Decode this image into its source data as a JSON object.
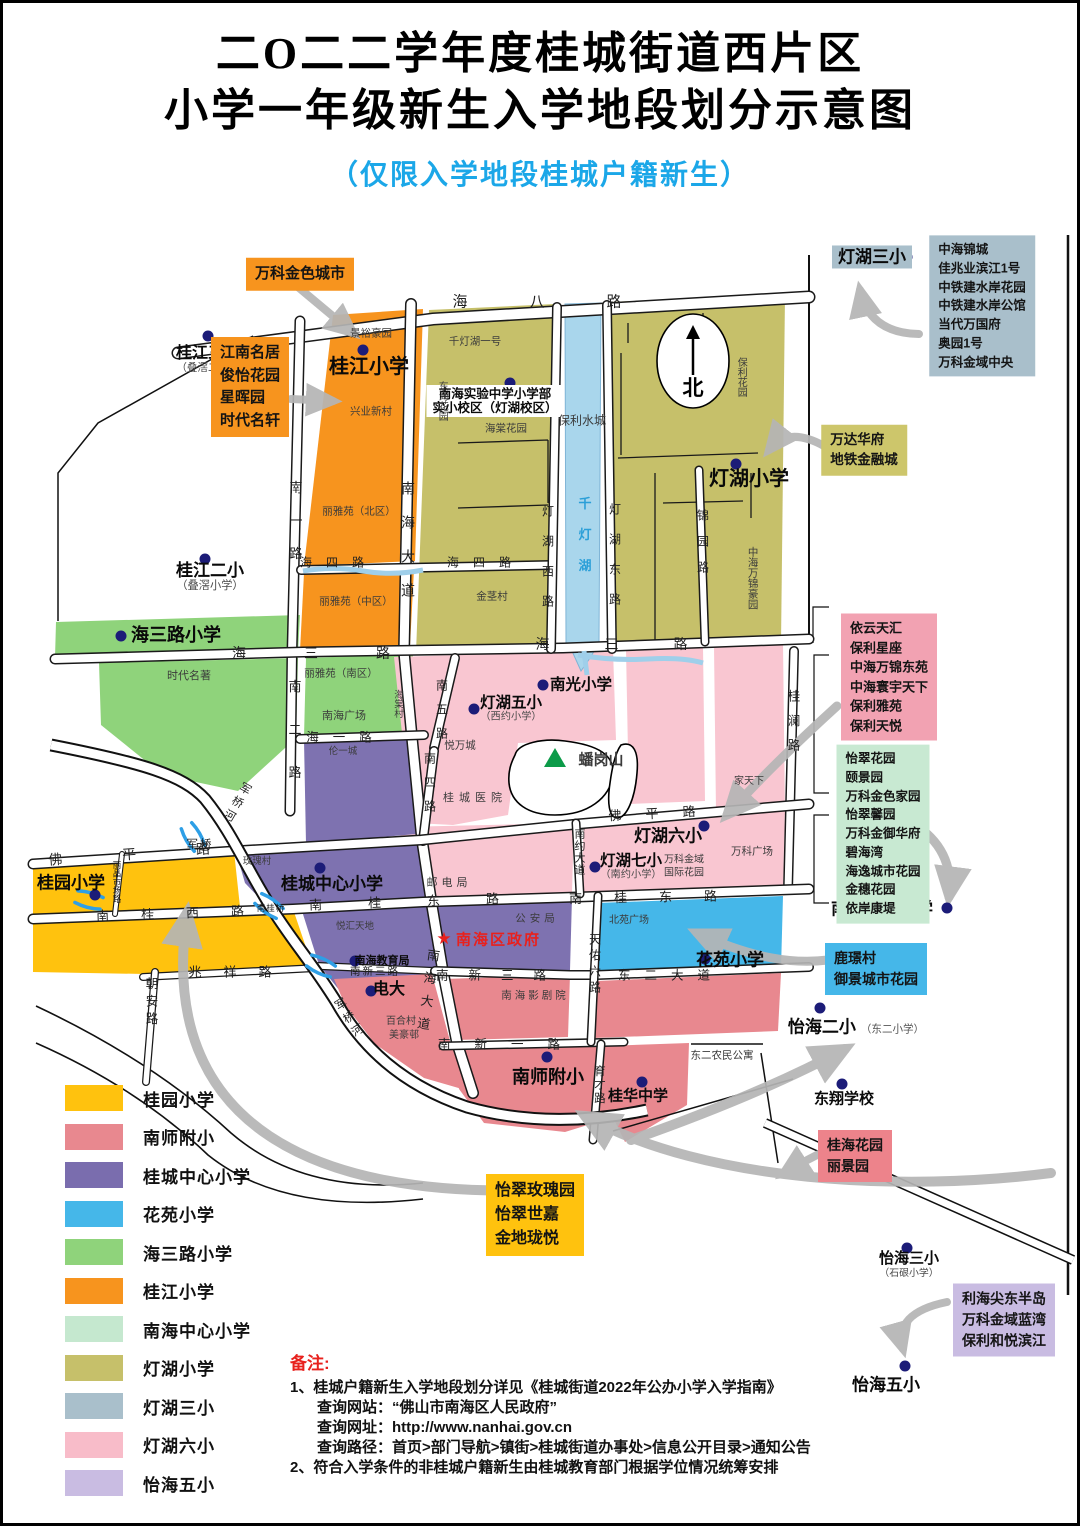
{
  "title": {
    "line1": "二O二二学年度桂城街道西片区",
    "line2": "小学一年级新生入学地段划分示意图",
    "subtitle": "（仅限入学地段桂城户籍新生）"
  },
  "legend": {
    "items": [
      {
        "label": "桂园小学",
        "color": "#FFC20E"
      },
      {
        "label": "南师附小",
        "color": "#E8888F"
      },
      {
        "label": "桂城中心小学",
        "color": "#7A6DAE"
      },
      {
        "label": "花苑小学",
        "color": "#45B7E9"
      },
      {
        "label": "海三路小学",
        "color": "#8FD37B"
      },
      {
        "label": "桂江小学",
        "color": "#F7941E"
      },
      {
        "label": "南海中心小学",
        "color": "#C5E8CF"
      },
      {
        "label": "灯湖小学",
        "color": "#C6C06A"
      },
      {
        "label": "灯湖三小",
        "color": "#A9BFCB"
      },
      {
        "label": "灯湖六小",
        "color": "#F8BCC9"
      },
      {
        "label": "怡海五小",
        "color": "#C9BCE2"
      }
    ]
  },
  "notes": {
    "heading": "备注:",
    "lines": [
      {
        "text": "1、桂城户籍新生入学地段划分详见《桂城街道2022年公办小学入学指南》",
        "indent": false
      },
      {
        "text": "查询网站：“佛山市南海区人民政府”",
        "indent": true
      },
      {
        "text": "查询网址：http://www.nanhai.gov.cn",
        "indent": true
      },
      {
        "text": "查询路径：首页>部门导航>镇街>桂城街道办事处>信息公开目录>通知公告",
        "indent": true
      },
      {
        "text": "2、符合入学条件的非桂城户籍新生由桂城教育部门根据学位情况统筹安排",
        "indent": false
      }
    ]
  },
  "map": {
    "north": "北",
    "star": {
      "sym": "★",
      "text": "南海区政府",
      "x": 441,
      "y": 936
    },
    "schools": [
      {
        "id": "guijiang-3",
        "name": "桂江三小",
        "sub": "（叠滘二小）",
        "x": 205,
        "y": 357,
        "s": 16,
        "dx": 205,
        "dy": 333
      },
      {
        "id": "guijiang",
        "name": "桂江小学",
        "x": 366,
        "y": 364,
        "s": 20,
        "dx": 360,
        "dy": 347
      },
      {
        "id": "shiyan",
        "name": "南海实验中学小学部",
        "sub2": "实小校区（灯湖校区）",
        "x": 492,
        "y": 398,
        "s": 12.5,
        "dx": 507,
        "dy": 380,
        "bg": "#ffffff"
      },
      {
        "id": "denghu",
        "name": "灯湖小学",
        "x": 746,
        "y": 476,
        "s": 20,
        "dx": 733,
        "dy": 461
      },
      {
        "id": "denghu-3",
        "name": "灯湖三小",
        "x": 869,
        "y": 254,
        "s": 17,
        "dx": 904,
        "dy": 254,
        "bg": "#A9BFCB"
      },
      {
        "id": "guijiang-2",
        "name": "桂江二小",
        "sub": "（叠滘小学）",
        "x": 207,
        "y": 574,
        "s": 17,
        "dx": 202,
        "dy": 556
      },
      {
        "id": "haisanlu",
        "name": "海三路小学",
        "x": 173,
        "y": 632,
        "s": 18,
        "dx": 118,
        "dy": 633
      },
      {
        "id": "nanguang",
        "name": "南光小学",
        "x": 578,
        "y": 682,
        "s": 15.5,
        "dx": 540,
        "dy": 682
      },
      {
        "id": "denghu-5",
        "name": "灯湖五小",
        "sub": "（西约小学）",
        "x": 508,
        "y": 706,
        "s": 15.5,
        "dx": 471,
        "dy": 706
      },
      {
        "id": "denghu-6",
        "name": "灯湖六小",
        "x": 665,
        "y": 833,
        "s": 17,
        "dx": 701,
        "dy": 823
      },
      {
        "id": "denghu-7",
        "name": "灯湖七小",
        "sub": "（南约小学）",
        "x": 628,
        "y": 864,
        "s": 15.5,
        "dx": 592,
        "dy": 864
      },
      {
        "id": "guiyuan",
        "name": "桂园小学",
        "x": 68,
        "y": 880,
        "s": 17,
        "dx": 92,
        "dy": 892
      },
      {
        "id": "guicheng-central",
        "name": "桂城中心小学",
        "x": 329,
        "y": 881,
        "s": 17,
        "dx": 317,
        "dy": 865
      },
      {
        "id": "edu-bureau",
        "name": "南海教育局",
        "x": 379,
        "y": 958,
        "s": 11,
        "dx": 352,
        "dy": 958
      },
      {
        "id": "dianda",
        "name": "电大",
        "x": 386,
        "y": 987,
        "s": 16,
        "dx": 368,
        "dy": 988
      },
      {
        "id": "nanshi",
        "name": "南师附小",
        "x": 545,
        "y": 1074,
        "s": 18,
        "dx": 544,
        "dy": 1054
      },
      {
        "id": "guihua",
        "name": "桂华中学",
        "x": 635,
        "y": 1094,
        "s": 15,
        "dx": 639,
        "dy": 1079
      },
      {
        "id": "huayuan",
        "name": "花苑小学",
        "x": 727,
        "y": 957,
        "s": 17,
        "dx": 702,
        "dy": 956
      },
      {
        "id": "nanhai-central",
        "name": "南海中心小学",
        "x": 879,
        "y": 906,
        "s": 17,
        "dx": 944,
        "dy": 905
      },
      {
        "id": "yihai-2",
        "name": "怡海二小",
        "subr": "（东二小学）",
        "x": 853,
        "y": 1024,
        "s": 17,
        "dx": 817,
        "dy": 1005
      },
      {
        "id": "dongxiang",
        "name": "东翔学校",
        "x": 841,
        "y": 1097,
        "s": 15,
        "dx": 839,
        "dy": 1081
      },
      {
        "id": "yihai-3",
        "name": "怡海三小",
        "sub": "（石硍小学）",
        "x": 906,
        "y": 1262,
        "s": 15,
        "dx": 904,
        "dy": 1245
      },
      {
        "id": "yihai-5",
        "name": "怡海五小",
        "x": 883,
        "y": 1382,
        "s": 17,
        "dx": 902,
        "dy": 1363
      }
    ],
    "areas": [
      {
        "t": "景裕豪园",
        "x": 368,
        "y": 331
      },
      {
        "t": "兴业新村",
        "x": 368,
        "y": 409
      },
      {
        "t": "丽雅苑（北区）",
        "x": 356,
        "y": 509
      },
      {
        "t": "丽雅苑（中区）",
        "x": 353,
        "y": 599
      },
      {
        "t": "丽雅苑（南区）",
        "x": 338,
        "y": 671
      },
      {
        "t": "南海广场",
        "x": 341,
        "y": 714,
        "s": 11
      },
      {
        "t": "时代名著",
        "x": 186,
        "y": 674,
        "s": 11
      },
      {
        "t": "伦一城",
        "x": 340,
        "y": 749,
        "s": 9.5
      },
      {
        "t": "千灯湖一号",
        "x": 472,
        "y": 339
      },
      {
        "t": "东海花园",
        "x": 438,
        "y": 398,
        "v": 1,
        "s": 10
      },
      {
        "t": "海棠花园",
        "x": 503,
        "y": 426
      },
      {
        "t": "保利水城",
        "x": 579,
        "y": 418,
        "s": 12
      },
      {
        "t": "保利花园",
        "x": 737,
        "y": 374,
        "v": 1,
        "s": 10
      },
      {
        "t": "中海万锦豪园",
        "x": 749,
        "y": 575,
        "v": 1,
        "s": 10.5
      },
      {
        "t": "金茎村",
        "x": 489,
        "y": 594
      },
      {
        "t": "海棠村",
        "x": 394,
        "y": 701,
        "v": 1,
        "s": 9.5
      },
      {
        "t": "悦万城",
        "x": 457,
        "y": 743
      },
      {
        "t": "桂城医院",
        "x": 472,
        "y": 796,
        "s": 11,
        "ls": 5
      },
      {
        "t": "玫瑰村",
        "x": 254,
        "y": 859,
        "s": 9.5
      },
      {
        "t": "悦汇天地",
        "x": 352,
        "y": 924,
        "s": 9.5
      },
      {
        "t": "邮电局",
        "x": 446,
        "y": 881,
        "s": 11,
        "ls": 4
      },
      {
        "t": "公安局",
        "x": 534,
        "y": 916,
        "s": 10.5,
        "ls": 4
      },
      {
        "t": "北苑广场",
        "x": 626,
        "y": 918,
        "s": 10
      },
      {
        "t": "家天下",
        "x": 746,
        "y": 779,
        "s": 10
      },
      {
        "t": "万科金域|国际花园",
        "x": 681,
        "y": 864,
        "s": 10
      },
      {
        "t": "万科广场",
        "x": 749,
        "y": 849,
        "s": 10.5
      },
      {
        "t": "百合村",
        "x": 398,
        "y": 1019,
        "s": 10
      },
      {
        "t": "美豪邨",
        "x": 401,
        "y": 1033,
        "s": 10
      },
      {
        "t": "南海影剧院",
        "x": 532,
        "y": 993,
        "s": 10.5,
        "ls": 3
      },
      {
        "t": "东二农民公寓",
        "x": 719,
        "y": 1053,
        "s": 10.5
      },
      {
        "t": "蟠岗山",
        "x": 598,
        "y": 758,
        "s": 15,
        "b": 1
      }
    ],
    "roads": [
      {
        "t": "海八路",
        "x": 565,
        "y": 298,
        "ls": 62,
        "s": 15
      },
      {
        "t": "海四路",
        "x": 336,
        "y": 559,
        "ls": 14,
        "s": 12
      },
      {
        "t": "海四路",
        "x": 483,
        "y": 559,
        "ls": 14,
        "s": 12
      },
      {
        "t": "海三路",
        "x": 337,
        "y": 650,
        "ls": 58,
        "s": 14
      },
      {
        "t": "海三路",
        "x": 636,
        "y": 641,
        "ls": 55,
        "s": 14
      },
      {
        "t": "海一路",
        "x": 343,
        "y": 733,
        "ls": 14,
        "s": 12.5
      },
      {
        "t": "佛平路",
        "x": 156,
        "y": 849,
        "ls": 60,
        "s": 14,
        "rot": -4
      },
      {
        "t": "佛平路",
        "x": 661,
        "y": 809,
        "ls": 24,
        "s": 13,
        "rot": -3
      },
      {
        "t": "南桂西路",
        "x": 183,
        "y": 909,
        "ls": 32,
        "s": 13,
        "rot": -2
      },
      {
        "t": "南桂东路",
        "x": 424,
        "y": 897,
        "ls": 46,
        "s": 13,
        "rot": -2
      },
      {
        "t": "南桂东路",
        "x": 656,
        "y": 893,
        "ls": 32,
        "s": 13,
        "rot": -1
      },
      {
        "t": "兆祥路",
        "x": 238,
        "y": 968,
        "ls": 22,
        "s": 13
      },
      {
        "t": "南新三路",
        "x": 372,
        "y": 968,
        "ls": 2,
        "s": 10.5
      },
      {
        "t": "南新三路",
        "x": 498,
        "y": 971,
        "ls": 20,
        "s": 12.5
      },
      {
        "t": "南新一路",
        "x": 508,
        "y": 1040,
        "ls": 24,
        "s": 12.5
      },
      {
        "t": "东二大道",
        "x": 668,
        "y": 971,
        "ls": 14,
        "s": 12.5
      },
      {
        "t": "南一路",
        "x": 292,
        "y": 527,
        "v": 1,
        "ls": 20,
        "s": 13
      },
      {
        "t": "南二路",
        "x": 291,
        "y": 741,
        "v": 1,
        "ls": 30,
        "s": 13
      },
      {
        "t": "南海大道",
        "x": 405,
        "y": 546,
        "v": 1,
        "ls": 20,
        "s": 14
      },
      {
        "t": "南海大道",
        "x": 424,
        "y": 991,
        "v": 1,
        "ls": 10,
        "s": 13,
        "rot": 8
      },
      {
        "t": "南五路",
        "x": 439,
        "y": 712,
        "v": 1,
        "ls": 12,
        "s": 12
      },
      {
        "t": "南四路",
        "x": 427,
        "y": 785,
        "v": 1,
        "ls": 12,
        "s": 12
      },
      {
        "t": "灯湖西路",
        "x": 545,
        "y": 562,
        "v": 1,
        "ls": 18,
        "s": 12
      },
      {
        "t": "灯湖东路",
        "x": 612,
        "y": 560,
        "v": 1,
        "ls": 18,
        "s": 12
      },
      {
        "t": "锦园路",
        "x": 700,
        "y": 545,
        "v": 1,
        "ls": 14,
        "s": 12
      },
      {
        "t": "桂澜路",
        "x": 790,
        "y": 723,
        "v": 1,
        "ls": 12,
        "s": 12.5
      },
      {
        "t": "南约大道",
        "x": 576,
        "y": 849,
        "v": 1,
        "ls": 1,
        "s": 11
      },
      {
        "t": "天佑六路",
        "x": 592,
        "y": 962,
        "v": 1,
        "ls": 4,
        "s": 12
      },
      {
        "t": "育才路",
        "x": 596,
        "y": 1082,
        "v": 1,
        "ls": 2,
        "s": 11.5
      },
      {
        "t": "朝安路",
        "x": 148,
        "y": 1000,
        "v": 1,
        "ls": 5,
        "s": 12.5
      },
      {
        "t": "丽晶市场路",
        "x": 114,
        "y": 879,
        "v": 1,
        "ls": 0,
        "s": 8.5
      },
      {
        "t": "千灯湖",
        "x": 581,
        "y": 540,
        "v": 1,
        "ls": 18,
        "s": 13,
        "blue": 1
      },
      {
        "t": "军桥河",
        "x": 233,
        "y": 800,
        "v": 1,
        "ls": 4,
        "s": 11.5,
        "rot": 30
      },
      {
        "t": "军桥河",
        "x": 346,
        "y": 1016,
        "v": 1,
        "ls": 4,
        "s": 11.5,
        "rot": -32
      },
      {
        "t": "军桥",
        "x": 197,
        "y": 841,
        "ls": 2,
        "s": 11.5
      },
      {
        "t": "南桂桥",
        "x": 268,
        "y": 905,
        "ls": 1,
        "s": 8.5
      }
    ],
    "callouts": [
      {
        "id": "callout-vanke-golden-city",
        "x": 297,
        "y": 271,
        "bg": "#F7941E",
        "fs": 15,
        "lines": [
          "万科金色城市"
        ]
      },
      {
        "id": "callout-jiangnan-list",
        "x": 247,
        "y": 384,
        "bg": "#F7941E",
        "fs": 15,
        "lines": [
          "江南名居",
          "俊怡花园",
          "星晖园",
          "时代名轩"
        ]
      },
      {
        "id": "callout-denghu3-list",
        "x": 979,
        "y": 303,
        "bg": "#A9BFCB",
        "fs": 12.5,
        "lines": [
          "中海锦城",
          "佳兆业滨江1号",
          "中铁建水岸花园",
          "中铁建水岸公馆",
          "当代万国府",
          "奥园1号",
          "万科金域中央"
        ]
      },
      {
        "id": "callout-wanda",
        "x": 861,
        "y": 447,
        "bg": "#CDC66B",
        "fs": 13.5,
        "lines": [
          "万达华府",
          "地铁金融城"
        ]
      },
      {
        "id": "callout-yiyun-list",
        "x": 886,
        "y": 674,
        "bg": "#F2A2B2",
        "fs": 13,
        "lines": [
          "依云天汇",
          "保利星座",
          "中海万锦东苑",
          "中海寰宇天下",
          "保利雅苑",
          "保利天悦"
        ]
      },
      {
        "id": "callout-yicui-list",
        "x": 880,
        "y": 831,
        "bg": "#C8E9D2",
        "fs": 12.5,
        "lines": [
          "怡翠花园",
          "颐景园",
          "万科金色家园",
          "怡翠馨园",
          "万科金御华府",
          "碧海湾",
          "海逸城市花园",
          "金穗花园",
          "依岸康堤"
        ]
      },
      {
        "id": "callout-lujing",
        "x": 873,
        "y": 966,
        "bg": "#45B7E9",
        "fs": 14,
        "lines": [
          "鹿璟村",
          "御景城市花园"
        ]
      },
      {
        "id": "callout-guihai",
        "x": 852,
        "y": 1153,
        "bg": "#ED838B",
        "fs": 14,
        "lines": [
          "桂海花园",
          "丽景园"
        ]
      },
      {
        "id": "callout-yicui-rose",
        "x": 532,
        "y": 1212,
        "bg": "#FFC20E",
        "fs": 16,
        "lines": [
          "怡翠玫瑰园",
          "怡翠世嘉",
          "金地珑悦"
        ]
      },
      {
        "id": "callout-lihai",
        "x": 1001,
        "y": 1317,
        "bg": "#C9BCE2",
        "fs": 14,
        "lines": [
          "利海尖东半岛",
          "万科金域蓝湾",
          "保利和悦滨江"
        ]
      }
    ]
  }
}
